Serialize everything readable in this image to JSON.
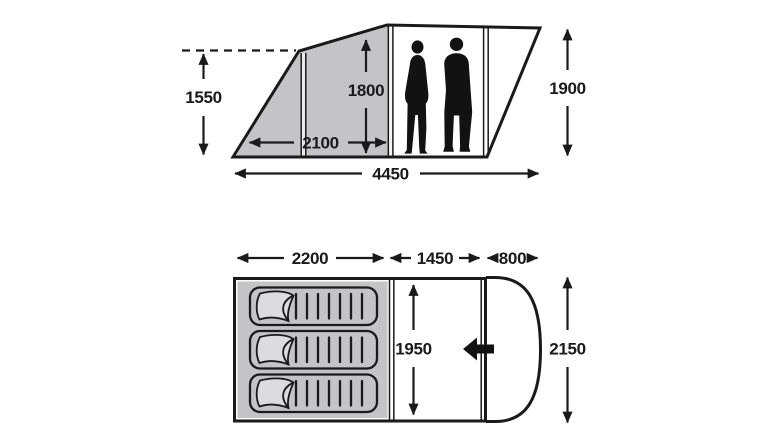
{
  "side_view": {
    "description": "tent side elevation with two standing occupants",
    "occupant_count": 2,
    "dims": {
      "front_section_height": "1550",
      "inner_height": "1800",
      "bedroom_length": "2100",
      "total_length": "4450",
      "standing_height": "1900"
    }
  },
  "floor_plan": {
    "description": "tent floor plan with sleeping area, living area and rounded porch",
    "sleeping_mat_count": 3,
    "entrance_arrow_direction": "left",
    "dims": {
      "bedroom_width": "2200",
      "living_width": "1450",
      "porch_depth": "800",
      "inner_depth": "1950",
      "total_depth": "2150"
    }
  },
  "colors": {
    "line": "#1a1a1a",
    "shaded_fabric": "#c4c4c6",
    "mat_flap": "#dcdcde",
    "background": "#ffffff"
  }
}
